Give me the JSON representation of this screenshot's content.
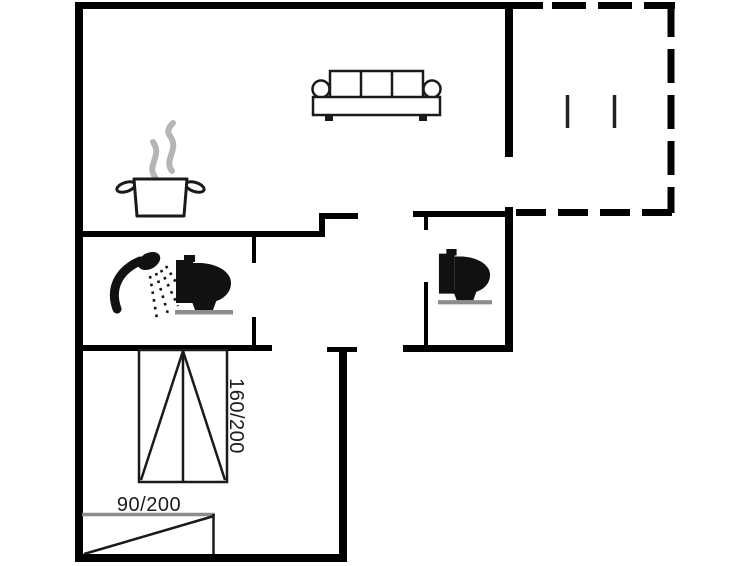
{
  "floorplan": {
    "background": "#ffffff",
    "wall_color": "#000000",
    "outline_color": "#1a1a1a",
    "steam_color": "#b5b5b5",
    "fixture_base_color": "#8c8c8c",
    "label_color": "#1c1c1c",
    "beds": {
      "double_bed_size": "160/200",
      "single_bed_size": "90/200"
    },
    "icons": [
      "sofa-icon",
      "cooking-pot-icon",
      "steam-icon",
      "shower-icon",
      "toilet-icon",
      "toilet-icon",
      "double-bed-icon",
      "single-bed-icon",
      "terrace-dashed-outline"
    ]
  }
}
